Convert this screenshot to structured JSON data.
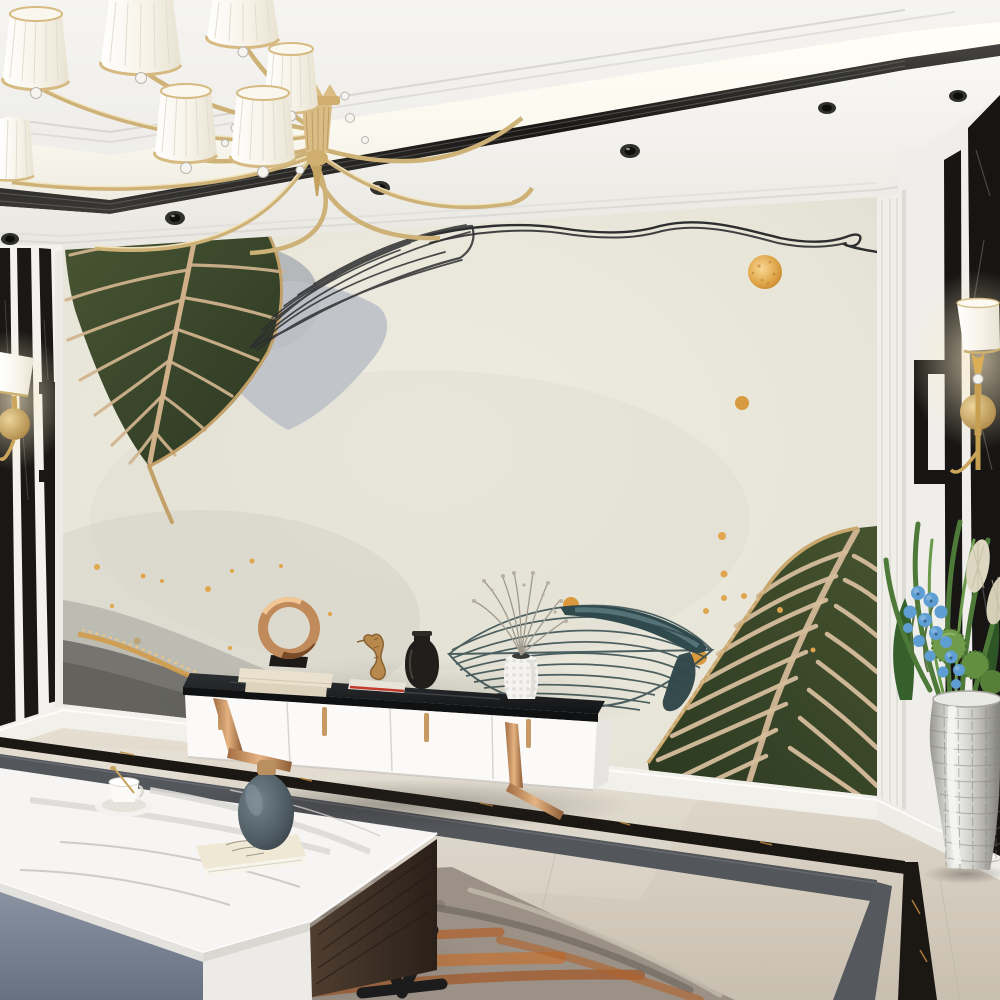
{
  "scene": {
    "type": "interior-3d-render",
    "description": "Modern living room with botanical leaf mural feature wall, gold chandelier, white media console and marble coffee table",
    "objects": {
      "chandelier": {
        "label": "gold chandelier with white pleated drum shades and crystal drops",
        "visible_shades": "7"
      },
      "ceiling": {
        "label": "coffered ceiling with lit cove, dark metal trim and recessed spotlights"
      },
      "downlights": {
        "label": "recessed ceiling spotlights",
        "count": "6"
      },
      "mural": {
        "label": "cream botanical mural feature wall",
        "motifs": [
          "dark green leaf with tan herringbone veins (top left)",
          "grey watercolour marble blob and soft grey leaf",
          "black line-art leaf (top centre)",
          "double wavy ink line with loop (top right)",
          "speckled gold foil dots",
          "teal watercolour line leaf (centre)",
          "large green leaf with cream veins (bottom right)",
          "grey stone texture with gold vein (bottom left)"
        ]
      },
      "left_panel": {
        "label": "black marble stripe panelling with greek-key jog and brass sconce"
      },
      "right_panel": {
        "label": "black marble panel with white greek-key inlay band"
      },
      "left_sconce": {
        "label": "brass wall sconce with white shade"
      },
      "right_sconce": {
        "label": "brass wall sconce with white shade"
      },
      "tv_console": {
        "label": "white media console, black marble top, copper strap legs",
        "decor": [
          "copper ring sculpture on black base and two cream books",
          "gold seahorse figurine on red-edged book",
          "dark glass bottle vase",
          "white hobnail vase with dried grey sprigs"
        ]
      },
      "coffee_table": {
        "label": "marble-top coffee table with grey and white drawer faces, dark wood side, black angular legs",
        "decor": [
          "white tea cup and saucer with gold spoon",
          "cream sketch-cover book",
          "blue-grey round vase with wooden stopper"
        ]
      },
      "plant": {
        "label": "silver mosaic floor vase with blue orchids, green pompons, pampas plumes and grasses"
      },
      "rug": {
        "label": "rust and grey abstract area rug"
      },
      "floor": {
        "label": "beige marble floor with double black marble border inlay"
      },
      "baseboard": {
        "label": "white skirting board"
      }
    }
  },
  "palette": {
    "ceiling": "#f1f0ec",
    "cove": "#fdfcf4",
    "trim_dark": "#2e2d2a",
    "soffit": "#f6f5f1",
    "wall_white": "#f2f1ed",
    "molding_shadow": "#d8d6d0",
    "mural_bg": "#e8e6da",
    "mural_frame": "#efede7",
    "leaf_green_dark": "#2f3b24",
    "leaf_green": "#475433",
    "leaf_vein_tan": "#d2b48f",
    "leaf_gold": "#c2a067",
    "line_ink": "#2d2e30",
    "gray_blob": "#b2b5b9",
    "gray_leaf": "#bcc0c6",
    "teal_dark": "#2f494d",
    "teal_light": "#5f7d82",
    "gold": "#dfa64f",
    "gold_light": "#f2cd8a",
    "stone_gray": "#7b7a74",
    "stone_dark": "#64635d",
    "stone_gold": "#d29a45",
    "marble_black": "#171513",
    "strip_gray": "#53565b",
    "floor_beige": "#d8d1c5",
    "floor_light": "#e7e1d7",
    "floor_dark": "#c3bbad",
    "rug_base": "#9b9186",
    "rug_orange": "#b0622c",
    "rug_gray": "#716d66",
    "cab_white": "#fbfaf8",
    "cab_top": "#1b1c1e",
    "copper": "#c08a5a",
    "copper_light": "#e3b384",
    "table_gray": "#7d8593",
    "wood_dark": "#43332a",
    "metal_black": "#1c1c1c",
    "vase_blue": "#5d6b73",
    "book_cream": "#ece3cd",
    "silver": "#cbcac6",
    "orchid_blue": "#5f9ed2",
    "plant_green": "#4f7a3c",
    "pampas": "#ddd7c1",
    "shade_white": "#f8f5ee",
    "brass": "#d0ae6e"
  }
}
